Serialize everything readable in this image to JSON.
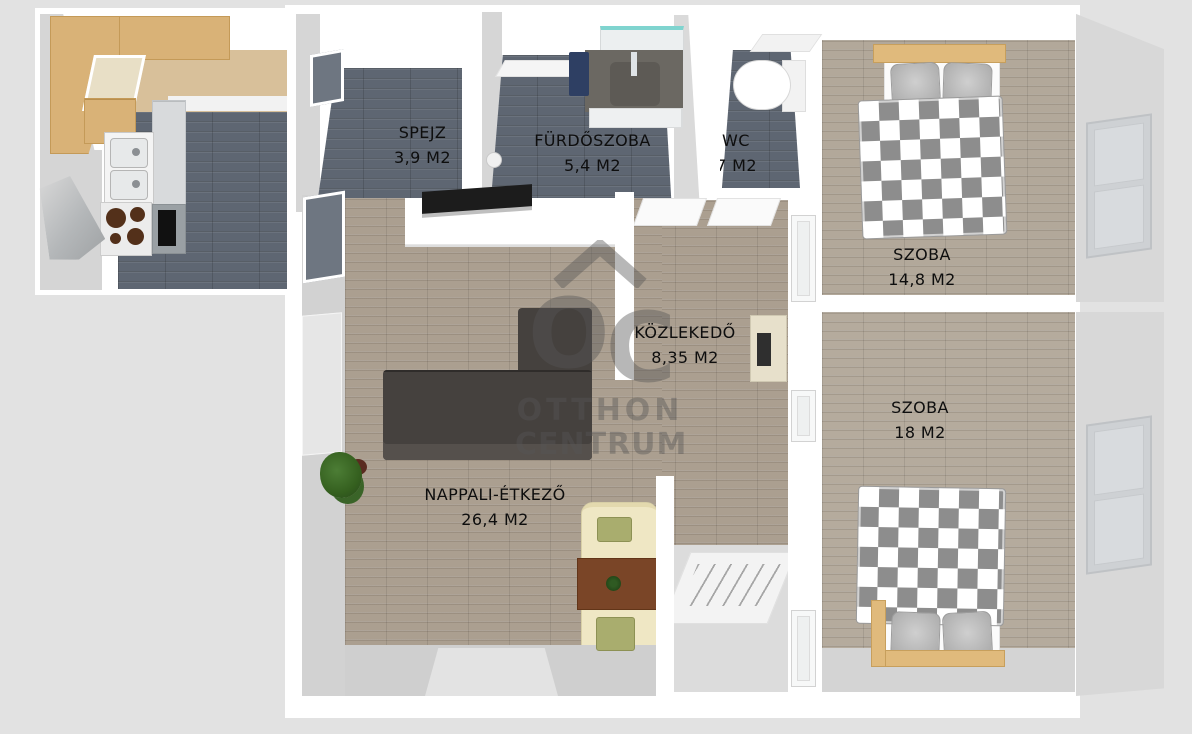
{
  "brand_watermark": {
    "logo_o": "O",
    "logo_c": "C",
    "line1": "OTTHON",
    "line2": "CENTRUM"
  },
  "rooms": {
    "spejz": {
      "name": "SPEJZ",
      "area": "3,9 M2"
    },
    "furdoszoba": {
      "name": "FÜRDŐSZOBA",
      "area": "5,4 M2"
    },
    "wc": {
      "name": "WC",
      "area": "1,7 M2"
    },
    "szoba_felso": {
      "name": "SZOBA",
      "area": "14,8 M2"
    },
    "szoba_also": {
      "name": "SZOBA",
      "area": "18 M2"
    },
    "kozlekedo": {
      "name": "KÖZLEKEDŐ",
      "area": "8,35 M2"
    },
    "nappali": {
      "name": "NAPPALI-ÉTKEZŐ",
      "area": "26,4 M2"
    }
  },
  "colors": {
    "background": "#e2e2e2",
    "wall": "#ffffff",
    "dark_tile_floor": "#5e6672",
    "wood_floor": "#ab9f90",
    "bedroom_floor": "#b2a89a",
    "sofa": "#45413e",
    "duvet_check": "#8d8d8d",
    "counter_wood": "#d9b277",
    "cream_seat": "#efe7c4",
    "table_brown": "#7a4527",
    "mirror_teal": "#7fd4cf",
    "watermark": "#565656"
  }
}
